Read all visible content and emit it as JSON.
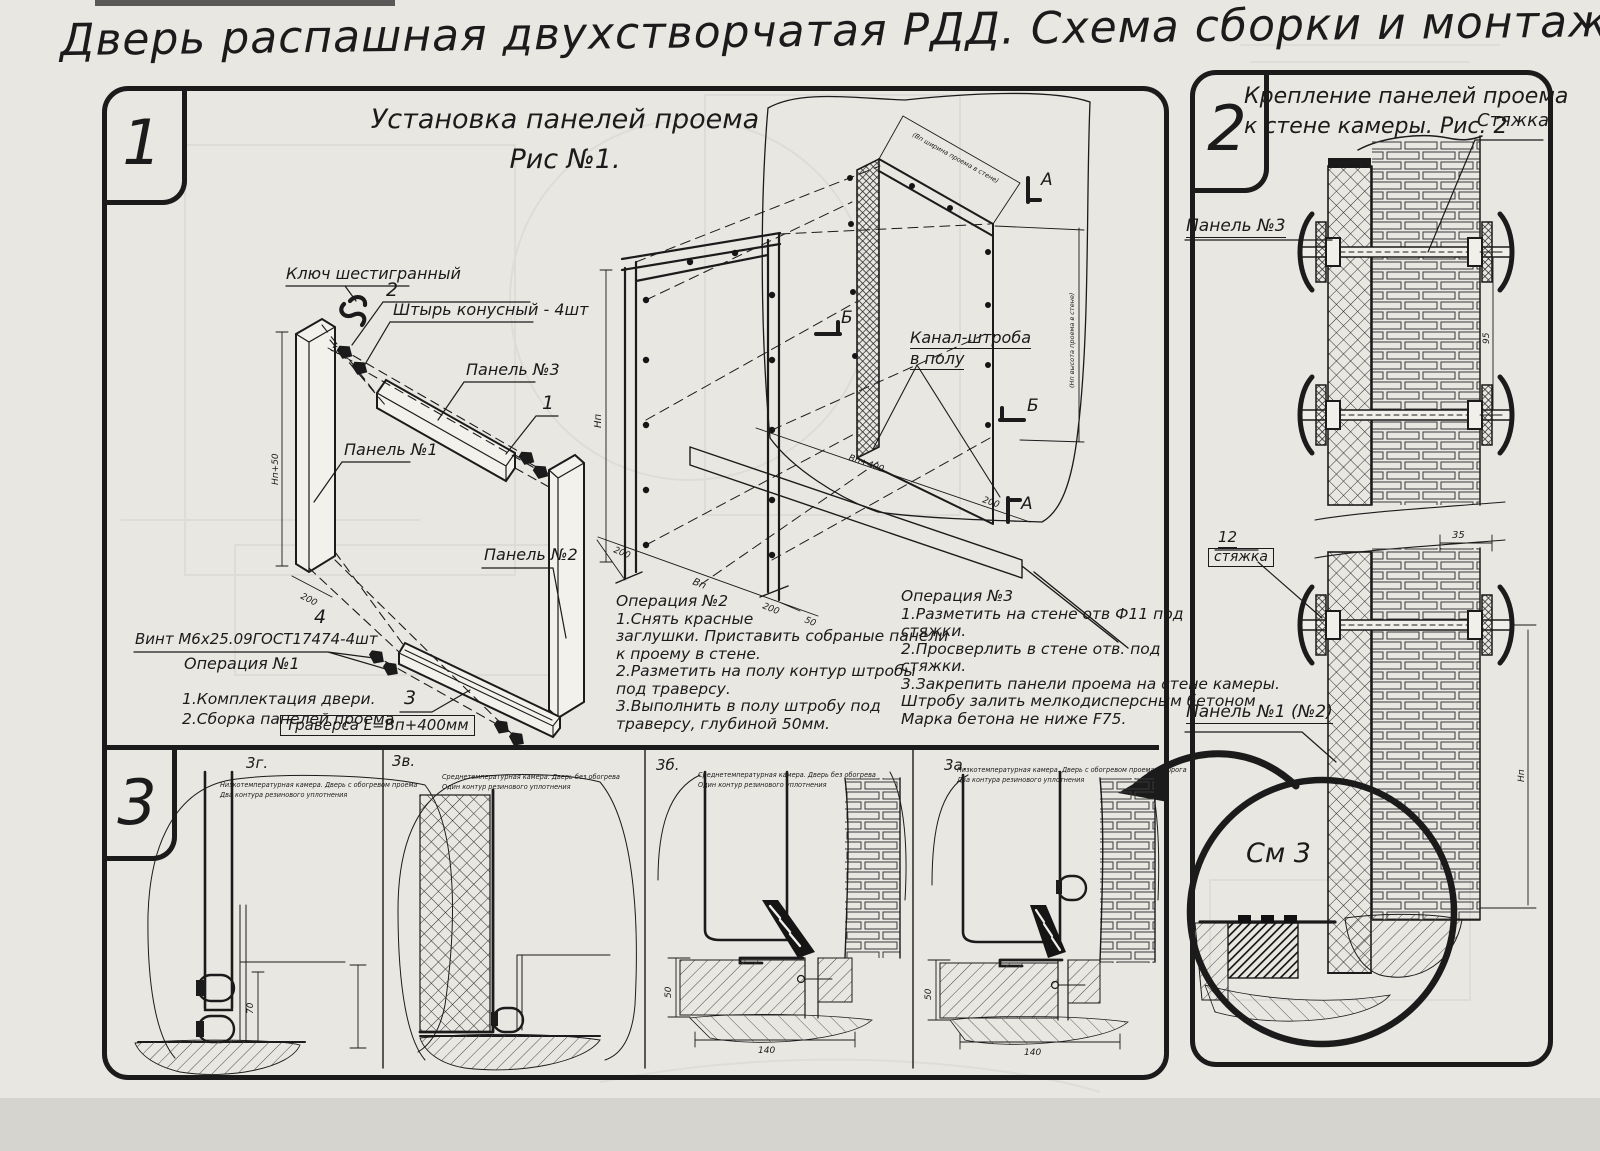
{
  "title": "Дверь распашная двухстворчатая РДД.  Схема сборки и монтажа №2",
  "colors": {
    "ink": "#1b1b1b",
    "paper": "#e9e7e2"
  },
  "s1": {
    "number": "1",
    "heading1": "Установка панелей проема",
    "heading2": "Рис №1.",
    "callouts": {
      "hex_key": "Ключ шестигранный",
      "pin_num": "2",
      "pin": "Штырь конусный - 4шт",
      "panel3": "Панель №3",
      "panel1": "Панель №1",
      "panel2": "Панель №2",
      "pos1": "1",
      "screw_num": "4",
      "screw": "Винт М6х25.09ГОСТ17474-4шт",
      "trav_num": "3",
      "trav": "Траверса  L=Вп+400мм",
      "channel1": "Канал-штроба",
      "channel2": "в полу",
      "mark_a": "А",
      "mark_b": "Б"
    },
    "op1": {
      "title": "Операция №1",
      "l1": "1.Комплектация двери.",
      "l2": "2.Сборка панелей проема"
    },
    "op2": {
      "lines": [
        "Операция №2",
        "1.Снять красные",
        "заглушки. Приставить собраные панели",
        "к проему в стене.",
        "2.Разметить на полу контур штробы",
        "под траверсу.",
        "3.Выполнить в полу штробу под",
        "траверсу, глубиной 50мм."
      ]
    },
    "op3": {
      "lines": [
        "Операция №3",
        "1.Разметить на стене отв Ф11 под",
        "стяжки.",
        "2.Просверлить в стене отв.   под",
        "стяжки.",
        "3.Закрепить панели проема на стене камеры.",
        "Штробу залить мелкодисперсным бетоном",
        "Марка бетона не ниже   F75."
      ]
    },
    "dims": {
      "np50": "Нп+50",
      "d200": "200",
      "d50": "50",
      "np": "Нп",
      "vp": "Вп",
      "vp400": "Вп+400",
      "open_w": "(Вп ширина проема в стене)",
      "open_h": "(Нп высота проема в стене)"
    }
  },
  "s2": {
    "number": "2",
    "heading1": "Крепление панелей проема",
    "heading2": "к стене камеры. Рис. 2",
    "labels": {
      "tie": "Стяжка",
      "panel3": "Панель №3",
      "pos12": "12",
      "tie2": "стяжка",
      "panel12": "Панель №1 (№2)",
      "see": "См 3"
    },
    "dims": {
      "d35": "35",
      "d95": "95",
      "hn": "Нп"
    }
  },
  "s3": {
    "number": "3",
    "figs": [
      {
        "id": "3г.",
        "c1": "Низкотемпературная камера. Дверь с обогревом проема",
        "c2": "Два контура резинового уплотнения"
      },
      {
        "id": "3в.",
        "c1": "Среднетемпературная камера. Дверь без обогрева",
        "c2": "Один контур резинового уплотнения"
      },
      {
        "id": "3б.",
        "c1": "Среднетемпературная камера. Дверь без обогрева",
        "c2": "Один контур резинового уплотнения"
      },
      {
        "id": "3а.",
        "c1": "Низкотемпературная камера. Дверь с обогревом проема и порога",
        "c2": "Два контура резинового уплотнения"
      }
    ],
    "dims": {
      "d70": "70",
      "d50": "50",
      "d140": "140"
    }
  }
}
